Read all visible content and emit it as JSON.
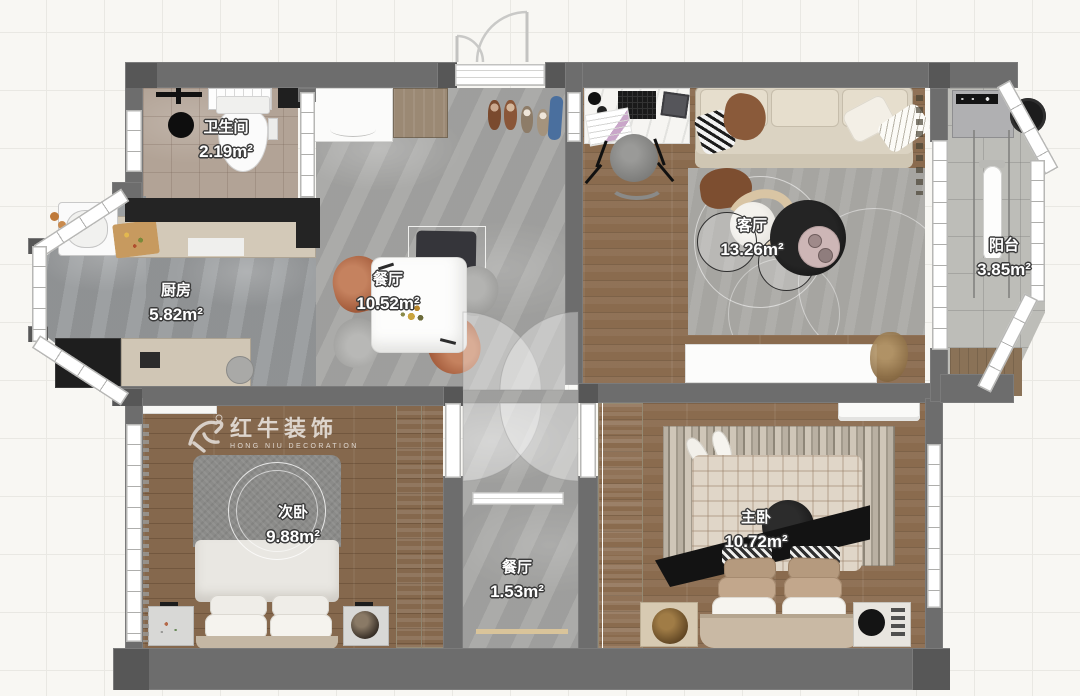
{
  "canvas": {
    "width": 1080,
    "height": 696
  },
  "watermark": {
    "brand": "红牛装饰",
    "registered": "®",
    "subtitle": "HONG NIU DECORATION"
  },
  "rooms": {
    "bathroom": {
      "name": "卫生间",
      "area": "2.19m²"
    },
    "kitchen": {
      "name": "厨房",
      "area": "5.82m²"
    },
    "dining": {
      "name": "餐厅",
      "area": "10.52m²"
    },
    "living": {
      "name": "客厅",
      "area": "13.26m²"
    },
    "balcony": {
      "name": "阳台",
      "area": "3.85m²"
    },
    "second_bedroom": {
      "name": "次卧",
      "area": "9.88m²"
    },
    "hallway": {
      "name": "餐厅",
      "area": "1.53m²"
    },
    "master_bedroom": {
      "name": "主卧",
      "area": "10.72m²"
    }
  },
  "palette": {
    "wall": "#6d6d6d",
    "wall_dark": "#242424",
    "wood_floor": "#8a6b4e",
    "tile_brown": "#b2a396",
    "marble_gray": "#a4a4a2",
    "sofa_cream": "#dbd3c2",
    "chair_terracotta": "#b5714f",
    "accent_black": "#141414"
  }
}
